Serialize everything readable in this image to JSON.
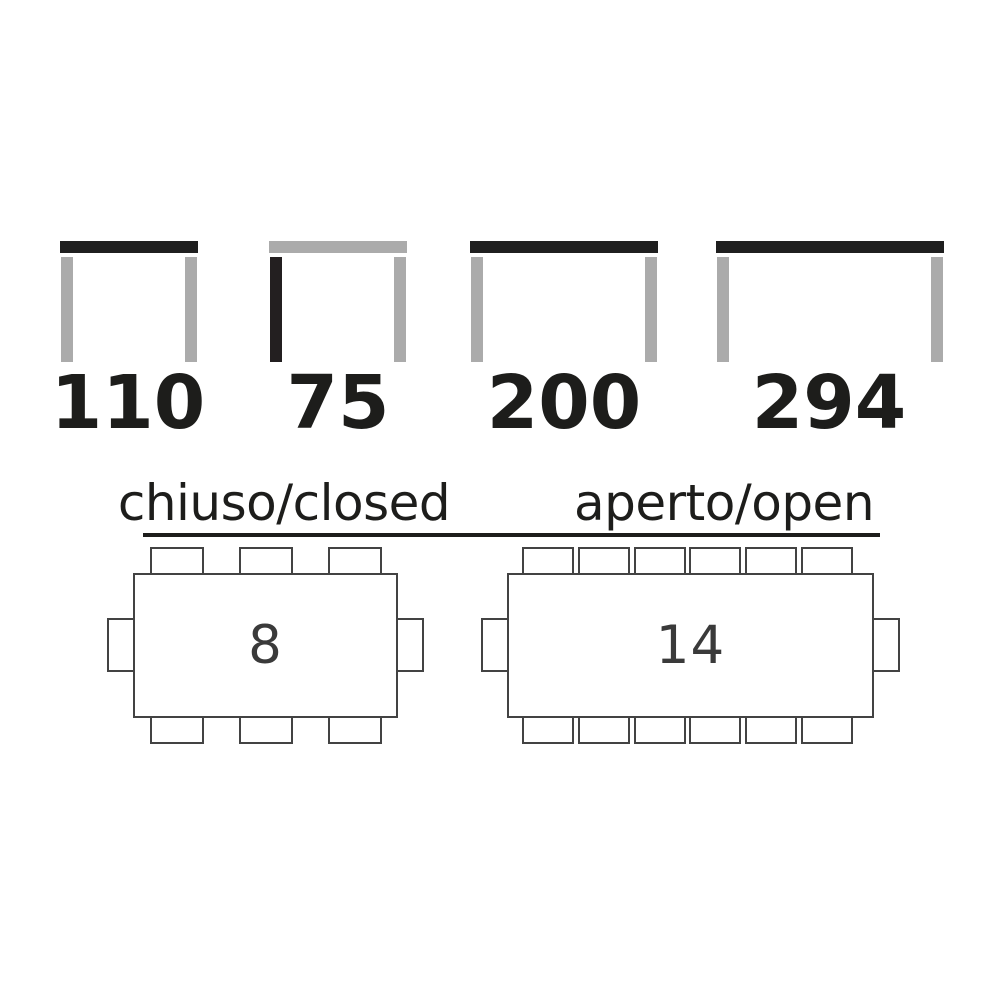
{
  "page": {
    "background_color": "#ffffff",
    "text_color": "#1d1d1b",
    "outline_color": "#434343",
    "highlight_dark": "#1f1f1f",
    "neutral_gray": "#ababab"
  },
  "dimension_icons": [
    {
      "value": "110",
      "top_bar_color": "#1f1f1f",
      "left_leg_color": "#ababab",
      "right_leg_color": "#ababab"
    },
    {
      "value": "75",
      "top_bar_color": "#ababab",
      "left_leg_color": "#231f20",
      "right_leg_color": "#ababab"
    },
    {
      "value": "200",
      "top_bar_color": "#1f1f1f",
      "left_leg_color": "#ababab",
      "right_leg_color": "#ababab"
    },
    {
      "value": "294",
      "top_bar_color": "#1f1f1f",
      "left_leg_color": "#ababab",
      "right_leg_color": "#ababab"
    }
  ],
  "seating": {
    "closed": {
      "label": "chiuso/closed",
      "seats": "8",
      "chairs_top": 3,
      "chairs_bottom": 3,
      "chairs_left": 1,
      "chairs_right": 1
    },
    "open": {
      "label": "aperto/open",
      "seats": "14",
      "chairs_top": 6,
      "chairs_bottom": 6,
      "chairs_left": 1,
      "chairs_right": 1
    }
  }
}
